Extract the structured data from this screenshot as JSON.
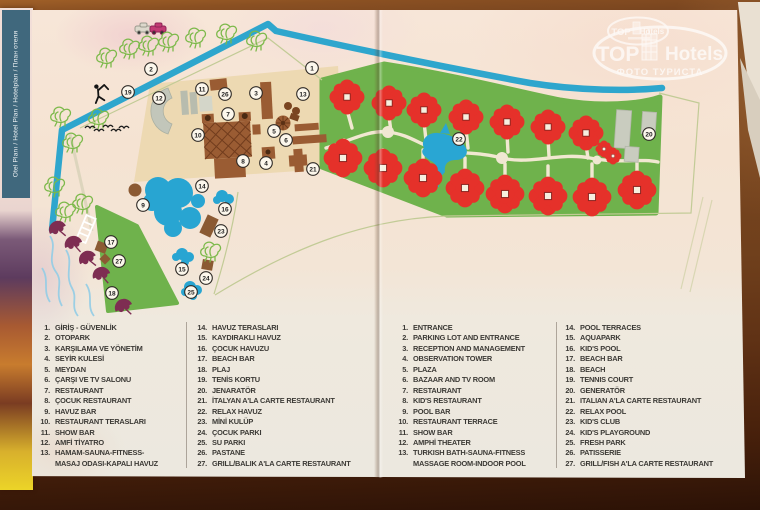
{
  "brochure": {
    "spine_label": "Otel Planı / Hotel Plan / Hotelplan / План отеля",
    "watermark": {
      "brand_top": "TOP",
      "brand_bottom": "Hotels",
      "subtitle": "ФОТО ТУРИСТА",
      "small_brand_top": "TOP",
      "small_brand_bottom": "Hotels"
    }
  },
  "map": {
    "colors": {
      "garden_green": "#6fb24c",
      "road_blue": "#2ea6cd",
      "water_blue": "#28a5d2",
      "bungalow_red": "#e5312a",
      "building_brown": "#9a5c33",
      "building_gray": "#c6c9bd",
      "umbrella_maroon": "#7e2d52",
      "path_cream": "#f1e8d1"
    },
    "markers": [
      {
        "n": "1",
        "x": 312,
        "y": 68
      },
      {
        "n": "2",
        "x": 151,
        "y": 69
      },
      {
        "n": "3",
        "x": 256,
        "y": 93
      },
      {
        "n": "4",
        "x": 266,
        "y": 163
      },
      {
        "n": "5",
        "x": 274,
        "y": 131
      },
      {
        "n": "6",
        "x": 286,
        "y": 140
      },
      {
        "n": "7",
        "x": 228,
        "y": 114
      },
      {
        "n": "8",
        "x": 243,
        "y": 161
      },
      {
        "n": "9",
        "x": 143,
        "y": 205
      },
      {
        "n": "10",
        "x": 198,
        "y": 135
      },
      {
        "n": "11",
        "x": 202,
        "y": 89
      },
      {
        "n": "12",
        "x": 159,
        "y": 98
      },
      {
        "n": "13",
        "x": 303,
        "y": 94
      },
      {
        "n": "14",
        "x": 202,
        "y": 186
      },
      {
        "n": "15",
        "x": 182,
        "y": 269
      },
      {
        "n": "16",
        "x": 225,
        "y": 209
      },
      {
        "n": "17",
        "x": 111,
        "y": 242
      },
      {
        "n": "18",
        "x": 112,
        "y": 293
      },
      {
        "n": "19",
        "x": 128,
        "y": 92
      },
      {
        "n": "20",
        "x": 649,
        "y": 134
      },
      {
        "n": "21",
        "x": 313,
        "y": 169
      },
      {
        "n": "22",
        "x": 459,
        "y": 139
      },
      {
        "n": "23",
        "x": 221,
        "y": 231
      },
      {
        "n": "24",
        "x": 206,
        "y": 278
      },
      {
        "n": "25",
        "x": 191,
        "y": 292
      },
      {
        "n": "26",
        "x": 225,
        "y": 94
      },
      {
        "n": "27",
        "x": 119,
        "y": 261
      }
    ],
    "bungalows": {
      "top": [
        [
          347,
          97
        ],
        [
          389,
          103
        ],
        [
          424,
          110
        ],
        [
          466,
          117
        ],
        [
          507,
          122
        ],
        [
          548,
          127
        ],
        [
          586,
          133
        ]
      ],
      "bottom": [
        [
          343,
          158
        ],
        [
          383,
          168
        ],
        [
          423,
          178
        ],
        [
          465,
          188
        ],
        [
          505,
          194
        ],
        [
          548,
          196
        ],
        [
          592,
          197
        ],
        [
          637,
          190
        ]
      ],
      "small": [
        [
          604,
          149
        ],
        [
          613,
          156
        ]
      ]
    },
    "trees": [
      [
        108,
        57
      ],
      [
        131,
        48
      ],
      [
        150,
        45
      ],
      [
        170,
        41
      ],
      [
        197,
        37
      ],
      [
        228,
        33
      ],
      [
        258,
        40
      ],
      [
        62,
        116
      ],
      [
        74,
        142
      ],
      [
        100,
        118
      ],
      [
        56,
        186
      ],
      [
        67,
        211
      ],
      [
        84,
        203
      ],
      [
        212,
        251
      ]
    ],
    "umbrellas": [
      [
        57,
        228,
        -28
      ],
      [
        73,
        243,
        -20
      ],
      [
        87,
        258,
        -30
      ],
      [
        101,
        274,
        -18
      ],
      [
        123,
        306,
        -25
      ]
    ],
    "birds": [
      [
        90,
        128
      ],
      [
        99,
        131
      ],
      [
        108,
        127
      ],
      [
        116,
        131
      ],
      [
        124,
        128
      ]
    ]
  },
  "legend": {
    "columns": [
      {
        "lang": "tr",
        "items": [
          {
            "n": "1.",
            "t": "GİRİŞ - GÜVENLİK"
          },
          {
            "n": "2.",
            "t": "OTOPARK"
          },
          {
            "n": "3.",
            "t": "KARŞILAMA VE YÖNETİM"
          },
          {
            "n": "4.",
            "t": "SEYİR KULESİ"
          },
          {
            "n": "5.",
            "t": "MEYDAN"
          },
          {
            "n": "6.",
            "t": "ÇARŞI VE TV SALONU"
          },
          {
            "n": "7.",
            "t": "RESTAURANT"
          },
          {
            "n": "8.",
            "t": "ÇOCUK RESTAURANT"
          },
          {
            "n": "9.",
            "t": "HAVUZ BAR"
          },
          {
            "n": "10.",
            "t": "RESTAURANT TERASLARI"
          },
          {
            "n": "11.",
            "t": "SHOW BAR"
          },
          {
            "n": "12.",
            "t": "AMFİ TİYATRO"
          },
          {
            "n": "13.",
            "t": "HAMAM-SAUNA-FITNESS-\nMASAJ ODASI-KAPALI HAVUZ"
          }
        ]
      },
      {
        "lang": "tr",
        "items": [
          {
            "n": "14.",
            "t": "HAVUZ TERASLARI"
          },
          {
            "n": "15.",
            "t": "KAYDIRAKLI HAVUZ"
          },
          {
            "n": "16.",
            "t": "ÇOCUK HAVUZU"
          },
          {
            "n": "17.",
            "t": "BEACH BAR"
          },
          {
            "n": "18.",
            "t": "PLAJ"
          },
          {
            "n": "19.",
            "t": "TENİS KORTU"
          },
          {
            "n": "20.",
            "t": "JENARATÖR"
          },
          {
            "n": "21.",
            "t": "İTALYAN A'LA CARTE RESTAURANT"
          },
          {
            "n": "22.",
            "t": "RELAX HAVUZ"
          },
          {
            "n": "23.",
            "t": "MİNİ KULÜP"
          },
          {
            "n": "24.",
            "t": "ÇOCUK PARKI"
          },
          {
            "n": "25.",
            "t": "SU PARKI"
          },
          {
            "n": "26.",
            "t": "PASTANE"
          },
          {
            "n": "27.",
            "t": "GRILL/BALIK A'LA CARTE RESTAURANT"
          }
        ]
      },
      {
        "lang": "en",
        "items": [
          {
            "n": "1.",
            "t": "ENTRANCE"
          },
          {
            "n": "2.",
            "t": "PARKING LOT AND ENTRANCE"
          },
          {
            "n": "3.",
            "t": "RECEPTION AND MANAGEMENT"
          },
          {
            "n": "4.",
            "t": "OBSERVATION TOWER"
          },
          {
            "n": "5.",
            "t": "PLAZA"
          },
          {
            "n": "6.",
            "t": "BAZAAR AND TV ROOM"
          },
          {
            "n": "7.",
            "t": "RESTAURANT"
          },
          {
            "n": "8.",
            "t": "KID'S RESTAURANT"
          },
          {
            "n": "9.",
            "t": "POOL BAR"
          },
          {
            "n": "10.",
            "t": "RESTAURANT TERRACE"
          },
          {
            "n": "11.",
            "t": "SHOW BAR"
          },
          {
            "n": "12.",
            "t": "AMPHİ THEATER"
          },
          {
            "n": "13.",
            "t": "TURKISH BATH-SAUNA-FITNESS\nMASSAGE ROOM-INDOOR POOL"
          }
        ]
      },
      {
        "lang": "en",
        "items": [
          {
            "n": "14.",
            "t": "POOL TERRACES"
          },
          {
            "n": "15.",
            "t": "AQUAPARK"
          },
          {
            "n": "16.",
            "t": "KID'S POOL"
          },
          {
            "n": "17.",
            "t": "BEACH BAR"
          },
          {
            "n": "18.",
            "t": "BEACH"
          },
          {
            "n": "19.",
            "t": "TENNIS COURT"
          },
          {
            "n": "20.",
            "t": "GENERATÖR"
          },
          {
            "n": "21.",
            "t": "ITALIAN A'LA CARTE RESTAURANT"
          },
          {
            "n": "22.",
            "t": "RELAX POOL"
          },
          {
            "n": "23.",
            "t": "KID'S CLUB"
          },
          {
            "n": "24.",
            "t": "KID'S PLAYGROUND"
          },
          {
            "n": "25.",
            "t": "FRESH PARK"
          },
          {
            "n": "26.",
            "t": "PATISSERIE"
          },
          {
            "n": "27.",
            "t": "GRILL/FISH A'LA CARTE RESTAURANT"
          }
        ]
      }
    ]
  }
}
